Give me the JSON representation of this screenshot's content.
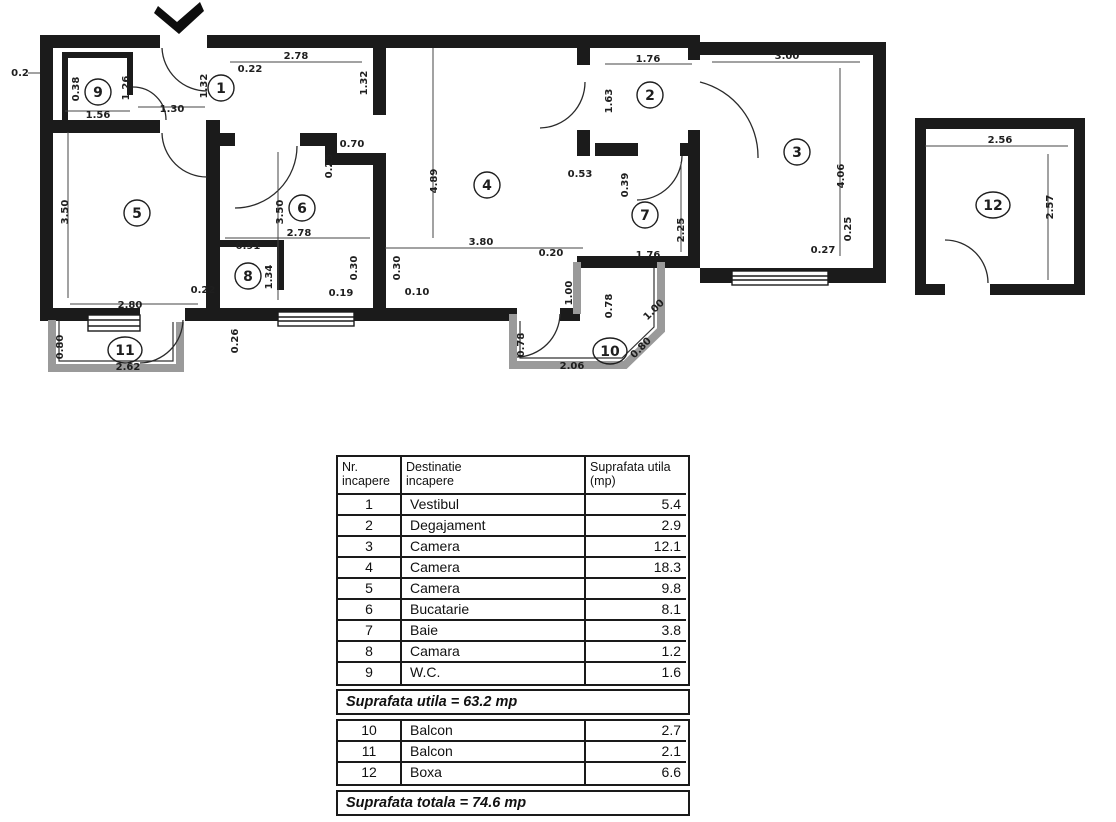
{
  "plan": {
    "rooms": [
      "1",
      "2",
      "3",
      "4",
      "5",
      "6",
      "7",
      "8",
      "9",
      "10",
      "11",
      "12"
    ],
    "dims": [
      "0.2",
      "0.38",
      "1.26",
      "1.56",
      "1.30",
      "2.78",
      "0.22",
      "1.32",
      "1.32",
      "1.76",
      "1.63",
      "3.00",
      "4.06",
      "0.25",
      "0.27",
      "4.89",
      "3.80",
      "0.20",
      "0.70",
      "0.25",
      "3.50",
      "2.78",
      "0.30",
      "0.30",
      "0.19",
      "0.10",
      "3.50",
      "2.80",
      "0.22",
      "0.91",
      "1.34",
      "0.26",
      "0.53",
      "0.39",
      "2.25",
      "1.76",
      "1.00",
      "0.78",
      "0.78",
      "1.00",
      "0.80",
      "2.06",
      "0.80",
      "2.62",
      "2.56",
      "2.57"
    ]
  },
  "table": {
    "header": {
      "col1_line1": "Nr.",
      "col1_line2": "incapere",
      "col2_line1": "Destinatie",
      "col2_line2": "incapere",
      "col3_line1": "Suprafata utila",
      "col3_line2": "(mp)"
    },
    "rows": [
      {
        "nr": "1",
        "name": "Vestibul",
        "area": "5.4"
      },
      {
        "nr": "2",
        "name": "Degajament",
        "area": "2.9"
      },
      {
        "nr": "3",
        "name": "Camera",
        "area": "12.1"
      },
      {
        "nr": "4",
        "name": "Camera",
        "area": "18.3"
      },
      {
        "nr": "5",
        "name": "Camera",
        "area": "9.8"
      },
      {
        "nr": "6",
        "name": "Bucatarie",
        "area": "8.1"
      },
      {
        "nr": "7",
        "name": "Baie",
        "area": "3.8"
      },
      {
        "nr": "8",
        "name": "Camara",
        "area": "1.2"
      },
      {
        "nr": "9",
        "name": "W.C.",
        "area": "1.6"
      }
    ],
    "subtotal": "Suprafata utila = 63.2 mp",
    "rows_annex": [
      {
        "nr": "10",
        "name": "Balcon",
        "area": "2.7"
      },
      {
        "nr": "11",
        "name": "Balcon",
        "area": "2.1"
      },
      {
        "nr": "12",
        "name": "Boxa",
        "area": "6.6"
      }
    ],
    "total": "Suprafata totala = 74.6 mp"
  },
  "colors": {
    "wall": "#1b1b1b",
    "balcony_wall": "#9a9a9a",
    "dim_text": "#1e1e1e"
  }
}
